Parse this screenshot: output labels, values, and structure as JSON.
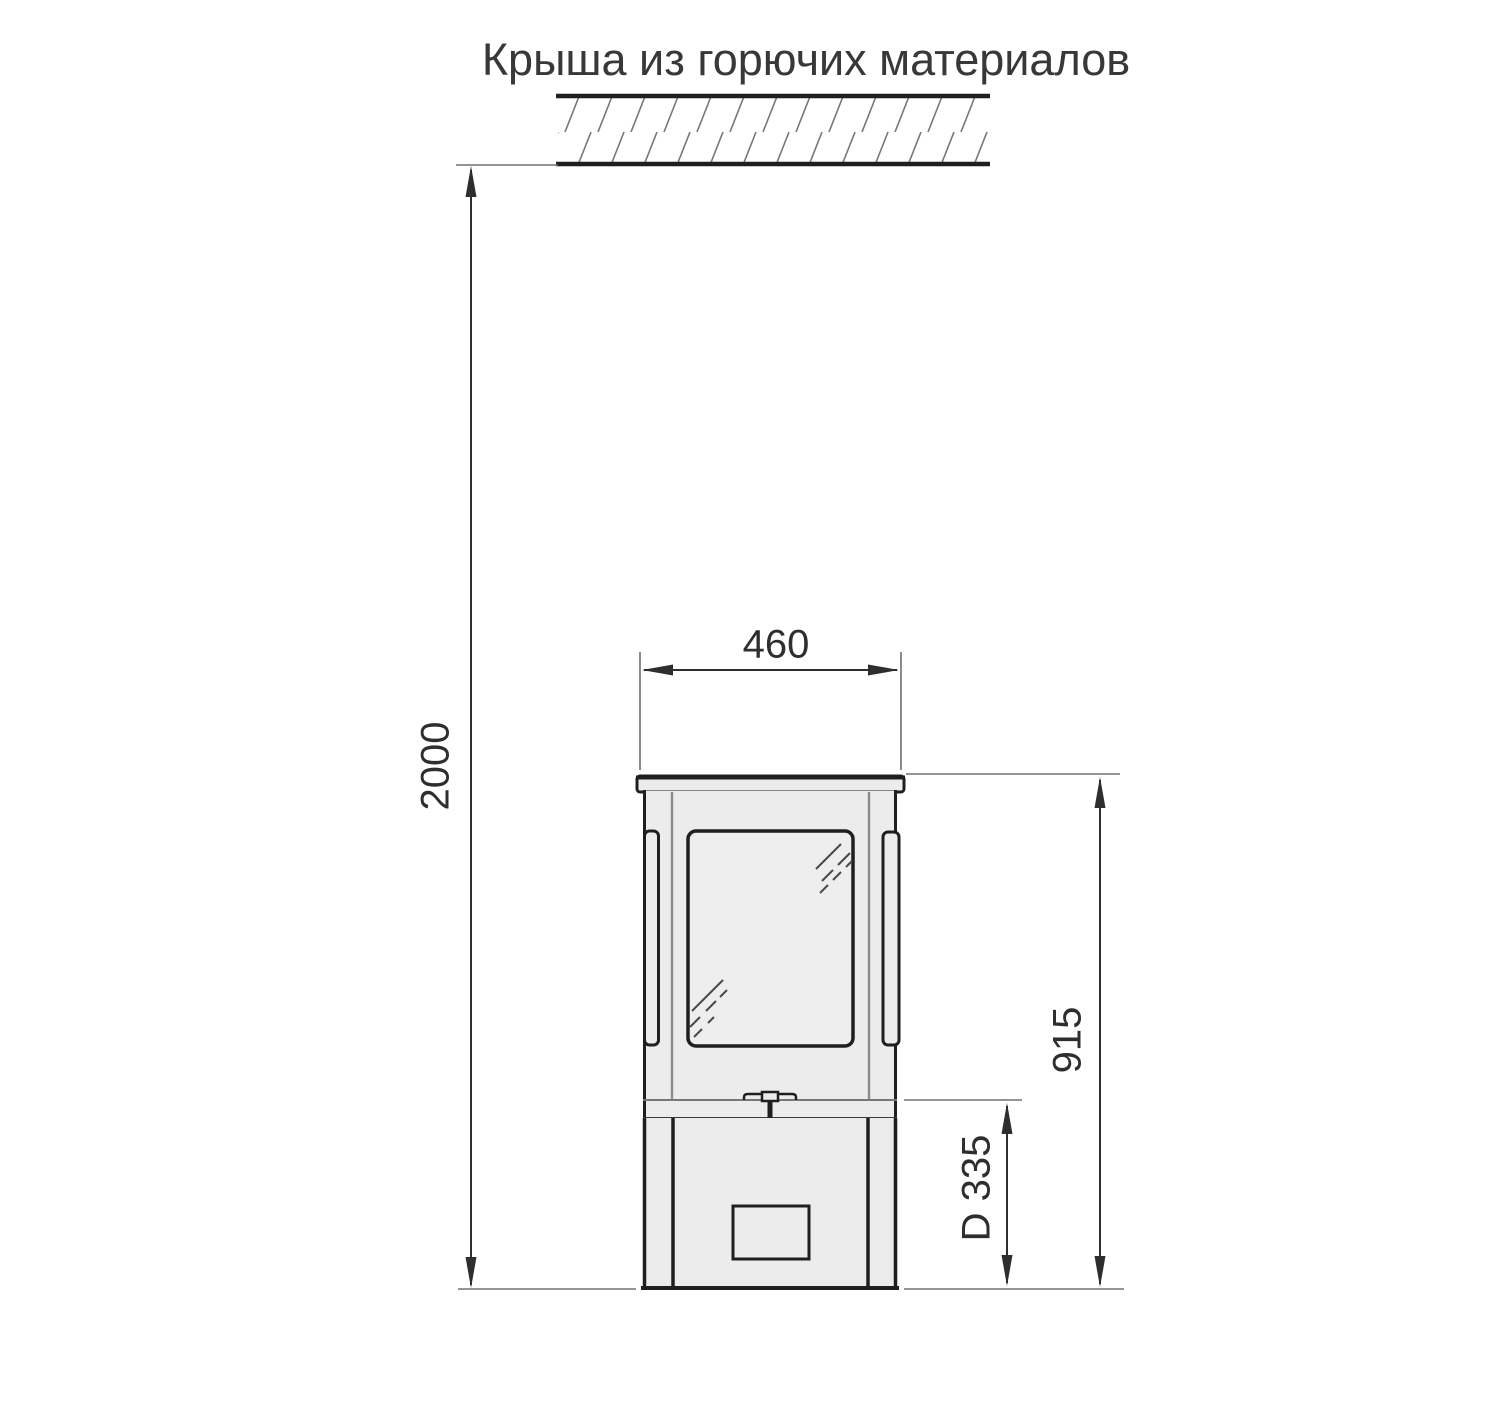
{
  "title": "Крыша из горючих материалов",
  "dimensions": {
    "roof_clearance": "2000",
    "stove_width": "460",
    "stove_height": "915",
    "flue_outlet": "D 335"
  },
  "colors": {
    "background": "#ffffff",
    "outline": "#1f1f1f",
    "thin_line": "#707070",
    "dimension_line": "#2e2e2e",
    "inner_line": "#8c8c8c",
    "stove_fill": "#ececec",
    "glass_fill": "#eeeeee",
    "text": "#383838"
  }
}
